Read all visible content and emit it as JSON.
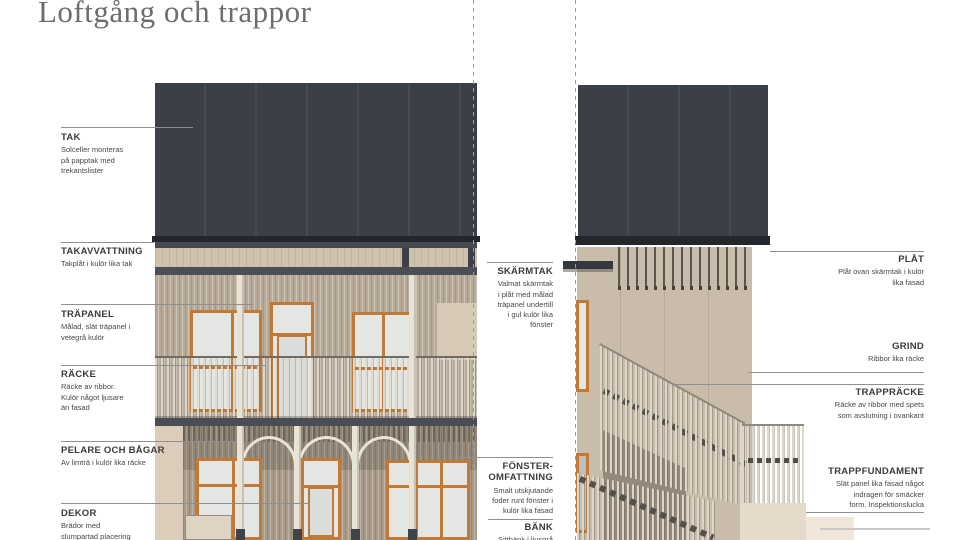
{
  "title": "Loftgång och trappor",
  "palette": {
    "roof": "#3b4048",
    "facade_upper": "#b7aa98",
    "facade_lower": "#a89b8a",
    "facade_right": "#c9bcaa",
    "window_frame": "#c07a35",
    "railing_rib": "#ddd7ca",
    "slab": "#4a4e54",
    "fundament": "#e6dacb",
    "leader_line": "#8f8f8f",
    "title_text": "#6d6d6d",
    "label_text": "#3b3b3b"
  },
  "annotations": {
    "left": [
      {
        "label": "TAK",
        "desc": "Solceller monteras\npå papptak med\ntrekantslister"
      },
      {
        "label": "TAKAVVATTNING",
        "desc": "Takplåt i kulör lika tak"
      },
      {
        "label": "TRÄPANEL",
        "desc": "Målad, slät träpanel i\nvetegrå kulör"
      },
      {
        "label": "RÄCKE",
        "desc": "Räcke av ribbor.\nKulör något ljusare\nän fasad"
      },
      {
        "label": "PELARE OCH BÅGAR",
        "desc": "Av limträ i kulör lika räcke"
      },
      {
        "label": "DEKOR",
        "desc": "Brädor med\nslumpartad placering"
      }
    ],
    "middle": [
      {
        "label": "SKÄRMTAK",
        "desc": "Valmat skärmtak\ni plåt med målad\nträpanel undertill\ni gul kulör lika\nfönster"
      },
      {
        "label": "FÖNSTER-\nOMFATTNING",
        "desc": "Smalt utskjutande\nfoder runt fönster i\nkulör lika fasad"
      },
      {
        "label": "BÄNK",
        "desc": "Sittbänk i ljusgrå"
      }
    ],
    "right": [
      {
        "label": "PLÅT",
        "desc": "Plåt ovan skärmtak i kulör\nlika fasad"
      },
      {
        "label": "GRIND",
        "desc": "Ribbor lika räcke"
      },
      {
        "label": "TRAPPRÄCKE",
        "desc": "Räcke av ribbor med spets\nsom avslutning i ovankant"
      },
      {
        "label": "TRAPPFUNDAMENT",
        "desc": "Slät panel lika fasad något\nindragen för smäcker\nform. Inspektionslucka"
      }
    ]
  }
}
